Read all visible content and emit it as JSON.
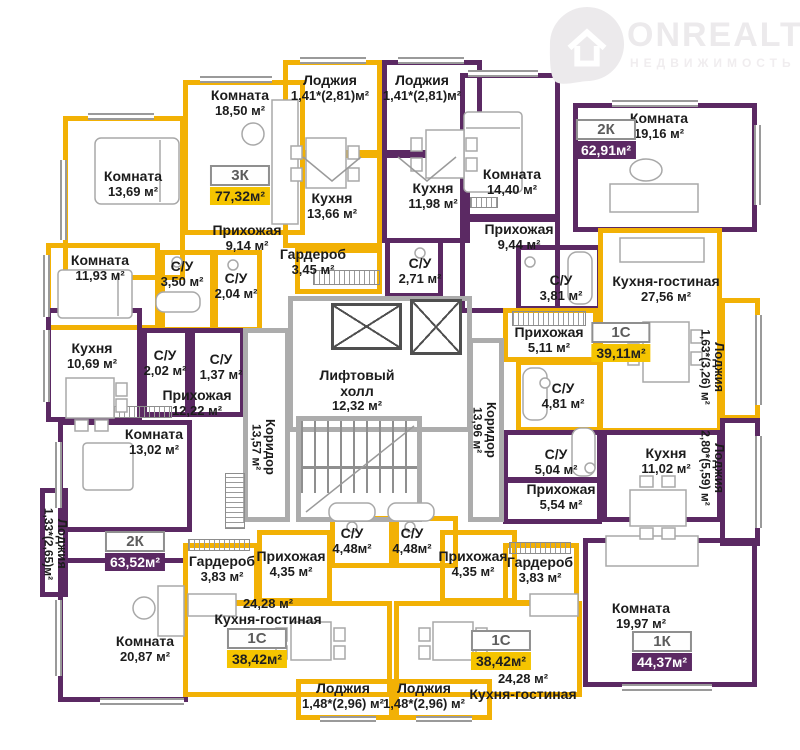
{
  "logo": {
    "brand": "ONREALT",
    "subtitle": "НЕДВИЖИМОСТЬ"
  },
  "colors": {
    "wall_yellow": "#F2B105",
    "wall_purple": "#5B2963",
    "badge_yellow": "#F5C400",
    "badge_purple": "#5B2963",
    "core_gray": "#ACACAC"
  },
  "apartments": {
    "a3k": {
      "type": "3К",
      "area": "77,32м²"
    },
    "a2k_top": {
      "type": "2К",
      "area": "62,91м²"
    },
    "a1s_mid": {
      "type": "1С",
      "area": "39,11м²"
    },
    "a2k_left": {
      "type": "2К",
      "area": "63,52м²"
    },
    "a1s_bl": {
      "type": "1С",
      "area": "38,42м²"
    },
    "a1s_br": {
      "type": "1С",
      "area": "38,42м²"
    },
    "a1k": {
      "type": "1К",
      "area": "44,37м²"
    }
  },
  "rooms": {
    "loggia_top_left": {
      "name": "Лоджия",
      "area": "1,41*(2,81)м²"
    },
    "loggia_top_right": {
      "name": "Лоджия",
      "area": "1,41*(2,81)м²"
    },
    "room_1850": {
      "name": "Комната",
      "area": "18,50 м²"
    },
    "room_1369": {
      "name": "Комната",
      "area": "13,69 м²"
    },
    "room_1193": {
      "name": "Комната",
      "area": "11,93 м²"
    },
    "kitchen_1366": {
      "name": "Кухня",
      "area": "13,66 м²"
    },
    "hall_914": {
      "name": "Прихожая",
      "area": "9,14 м²"
    },
    "su_350": {
      "name": "С/У",
      "area": "3,50 м²"
    },
    "su_204": {
      "name": "С/У",
      "area": "2,04 м²"
    },
    "wardrobe_345": {
      "name": "Гардероб",
      "area": "3,45 м²"
    },
    "kitchen_1198": {
      "name": "Кухня",
      "area": "11,98 м²"
    },
    "room_1440": {
      "name": "Комната",
      "area": "14,40 м²"
    },
    "hall_944": {
      "name": "Прихожая",
      "area": "9,44 м²"
    },
    "su_271": {
      "name": "С/У",
      "area": "2,71 м²"
    },
    "room_1916": {
      "name": "Комната",
      "area": "19,16 м²"
    },
    "su_381": {
      "name": "С/У",
      "area": "3,81 м²"
    },
    "kg_2756": {
      "name": "Кухня-гостиная",
      "area": "27,56 м²"
    },
    "hall_511": {
      "name": "Прихожая",
      "area": "5,11 м²"
    },
    "su_481": {
      "name": "С/У",
      "area": "4,81 м²"
    },
    "loggia_163": {
      "name": "Лоджия",
      "area": "1,63*(3,26) м²"
    },
    "kitchen_1069": {
      "name": "Кухня",
      "area": "10,69 м²"
    },
    "su_202": {
      "name": "С/У",
      "area": "2,02 м²"
    },
    "su_137": {
      "name": "С/У",
      "area": "1,37 м²"
    },
    "hall_1222": {
      "name": "Прихожая",
      "area": "12,22 м²"
    },
    "room_1302": {
      "name": "Комната",
      "area": "13,02 м²"
    },
    "loggia_133": {
      "name": "Лоджия",
      "area": "1,33*(2,65)м²"
    },
    "room_2087": {
      "name": "Комната",
      "area": "20,87 м²"
    },
    "lift_hall": {
      "name": "Лифтовый холл",
      "area": "12,32 м²"
    },
    "corridor_l": {
      "name": "Коридор",
      "area": "13,57 м²"
    },
    "corridor_r": {
      "name": "Коридор",
      "area": "13,96 м²"
    },
    "su_504": {
      "name": "С/У",
      "area": "5,04 м²"
    },
    "kitchen_1102": {
      "name": "Кухня",
      "area": "11,02 м²"
    },
    "hall_554": {
      "name": "Прихожая",
      "area": "5,54 м²"
    },
    "loggia_280": {
      "name": "Лоджия",
      "area": "2,80*(5,59) м²"
    },
    "room_1997": {
      "name": "Комната",
      "area": "19,97 м²"
    },
    "wardrobe_bl": {
      "name": "Гардероб",
      "area": "3,83 м²"
    },
    "hall_bl": {
      "name": "Прихожая",
      "area": "4,35 м²"
    },
    "su_448_l": {
      "name": "С/У",
      "area": "4,48м²"
    },
    "su_448_r": {
      "name": "С/У",
      "area": "4,48м²"
    },
    "hall_br": {
      "name": "Прихожая",
      "area": "4,35 м²"
    },
    "wardrobe_br": {
      "name": "Гардероб",
      "area": "3,83 м²"
    },
    "kg_2428_l": {
      "name": "Кухня-гостиная",
      "area": "24,28 м²"
    },
    "kg_2428_r": {
      "name": "Кухня-гостиная",
      "area": "24,28 м²"
    },
    "loggia_148_l": {
      "name": "Лоджия",
      "area": "1,48*(2,96) м²"
    },
    "loggia_148_r": {
      "name": "Лоджия",
      "area": "1,48*(2,96) м²"
    }
  }
}
